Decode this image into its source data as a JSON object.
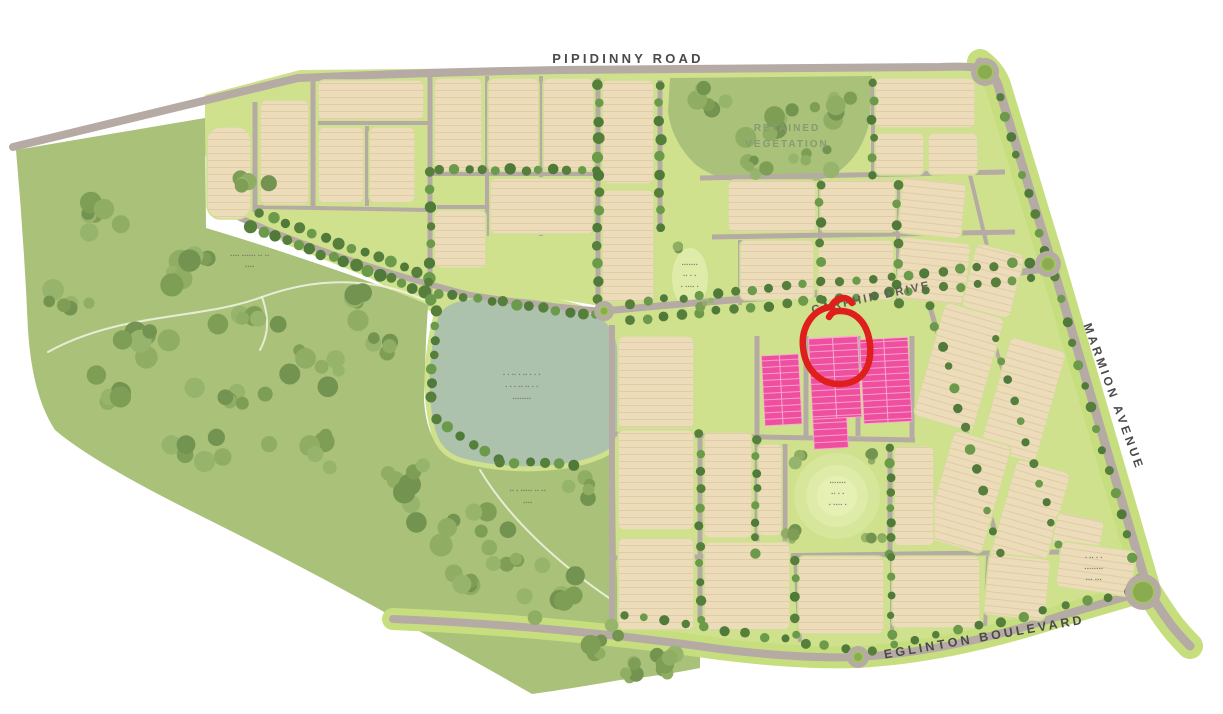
{
  "map_labels": {
    "pipidinny_road": "PIPIDINNY ROAD",
    "carphin_drive": "CARPHIN DRIVE",
    "marmion_avenue": "MARMION AVENUE",
    "eglinton_boulevard": "EGLINTON BOULEVARD",
    "retained_vegetation": {
      "line1": "RETAINED",
      "line2": "VEGETATION"
    }
  },
  "illegible_labels": {
    "bushland_west": [
      "▪▪▪▪ ▪▪▪▪▪▪ ▪▪ ▪▪",
      "▪▪▪▪"
    ],
    "lake": [
      "▪ ▪ ▪▪ ▪ ▪▪ ▪ ▪ ▪",
      "▪ ▪ ▪ ▪▪ ▪▪ ▪ ▪",
      "▪▪▪▪▪▪▪▪"
    ],
    "bushland_south": [
      "▪▪ ▪ ▪▪▪▪▪ ▪▪ ▪▪",
      "▪▪▪▪"
    ],
    "central_park": [
      "▪▪▪▪▪▪▪",
      "▪▪ ▪ ▪",
      "▪ ▪▪▪▪ ▪"
    ],
    "north_park": [
      "▪▪▪▪▪▪▪",
      "▪▪ ▪ ▪",
      "▪ ▪▪▪▪ ▪"
    ],
    "southeast_block": [
      "▪ ▪▪ ▪ ▪",
      "▪▪▪▪▪▪▪▪",
      "▪▪▪ ▪▪▪"
    ]
  },
  "annotation": {
    "shape": "hand-drawn circle",
    "color": "#df1f1c"
  },
  "colors": {
    "background": "#ffffff",
    "bushland": "#a9c178",
    "parkland": "#cfe18d",
    "lake": "#adc2ad",
    "lot_fill": "#ecdcba",
    "lot_line": "#dfcaa3",
    "road": "#b6aaa4",
    "road_verge": "#c7de7f",
    "street_tree": "#567f3b",
    "highlight_pink": "#ee4f9f",
    "highlight_pink_line": "#f9a9d0",
    "annotation_red": "#df1f1c",
    "label_dark": "#4a4a4a",
    "label_green": "#879a74",
    "illegible_text": "#6e6e62"
  }
}
